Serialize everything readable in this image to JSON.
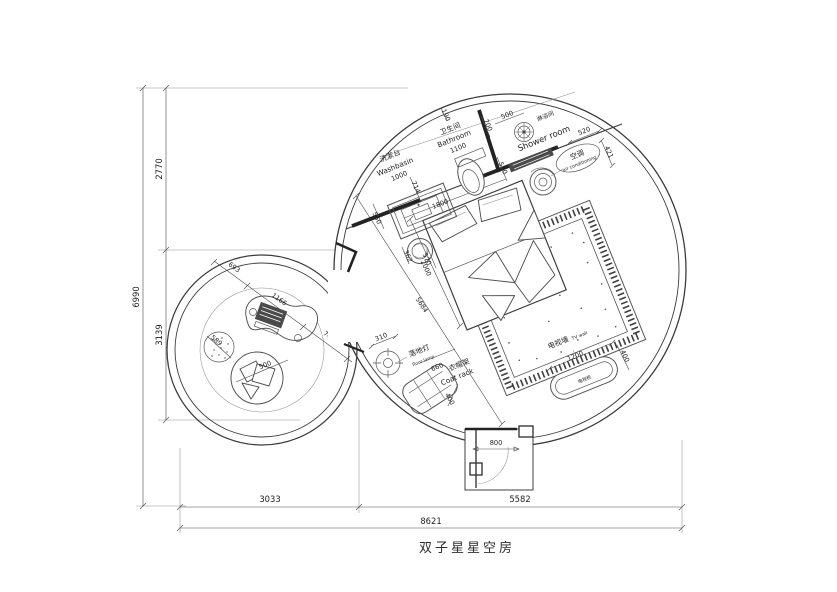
{
  "title": "双子星星空房",
  "dims": {
    "h6990": "6990",
    "h2770": "2770",
    "h3139": "3139",
    "w3033": "3033",
    "w5582": "5582",
    "w8621": "8621",
    "n190": "190",
    "n700": "700",
    "n500a": "500",
    "n590": "590",
    "n520": "520",
    "n421": "421",
    "n550": "550",
    "n714": "714",
    "n1000": "1000",
    "n1100": "1100",
    "n1800": "1800",
    "n2000": "2000",
    "n570": "570",
    "n362": "362",
    "n5684": "5684",
    "n693": "693",
    "n1166": "1166",
    "n745": "745",
    "n589": "589",
    "n500b": "500",
    "n310": "310",
    "n660": "660",
    "n400a": "400",
    "n800": "800",
    "n1200": "1200",
    "n400b": "400"
  },
  "labels": {
    "washbasin_cn": "洗漱台",
    "washbasin_en": "Washbasin",
    "bathroom_cn": "卫生间",
    "bathroom_en": "Bathroom",
    "shower_cn": "淋浴间",
    "shower_en": "Shower room",
    "ac_cn": "空调",
    "ac_en": "air conditioning",
    "floor_lamp_cn": "落地灯",
    "floor_lamp_en": "floor lamp",
    "coat_rack_cn": "衣帽架",
    "coat_rack_en": "Coat rack",
    "tv_wall_cn": "电视墙",
    "tv_wall_en": "TV wall",
    "tv_cabinet": "电视柜"
  },
  "colors": {
    "line": "#3c3c3c",
    "bold_wall": "#232323",
    "thin": "#909090",
    "text": "#1d1d1d",
    "bg": "#ffffff"
  }
}
